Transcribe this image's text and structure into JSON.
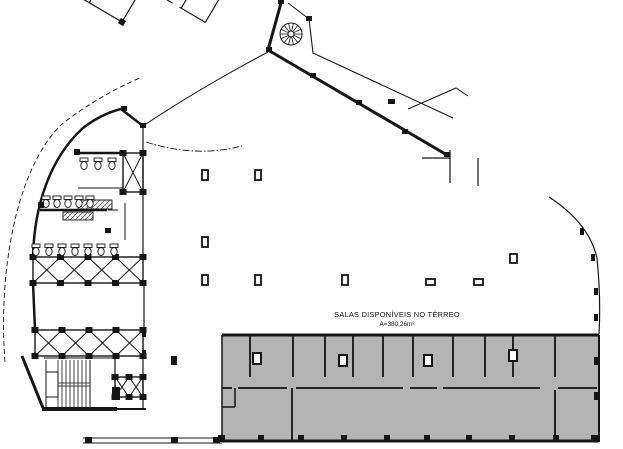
{
  "plan": {
    "labels": {
      "title": "SALAS DISPONÍVEIS NO TÉRREO",
      "area": "A=380,26m²"
    },
    "colors": {
      "line": "#151515",
      "gray_fill": "#b4b4b4",
      "background": "#ffffff"
    },
    "segments": [
      [
        281,
        3,
        268,
        50,
        3
      ],
      [
        268,
        50,
        447,
        155,
        3
      ],
      [
        121,
        109,
        143,
        126,
        2.5
      ],
      [
        77,
        153,
        123,
        153,
        2.5
      ],
      [
        78,
        188,
        123,
        188,
        1
      ],
      [
        40,
        210,
        107,
        210,
        2.5
      ],
      [
        108,
        210,
        118,
        210,
        1
      ],
      [
        125,
        203,
        125,
        240,
        1
      ],
      [
        143,
        126,
        143,
        258,
        1.2
      ],
      [
        144,
        283,
        144,
        330,
        1.2
      ],
      [
        33,
        283,
        35,
        330,
        2.5
      ],
      [
        143,
        357,
        143,
        408,
        1.2
      ],
      [
        44,
        358,
        115,
        358,
        1
      ],
      [
        115,
        358,
        115,
        377,
        1.2
      ],
      [
        46,
        360,
        46,
        407,
        1
      ],
      [
        90,
        360,
        90,
        407,
        1
      ],
      [
        46,
        383,
        90,
        383,
        0.8
      ],
      [
        46,
        386,
        90,
        386,
        0.8
      ],
      [
        22,
        356,
        43,
        408,
        3
      ],
      [
        42,
        409,
        117,
        409,
        4
      ],
      [
        117,
        409,
        146,
        409,
        2
      ],
      [
        83,
        438,
        222,
        438,
        1
      ],
      [
        83,
        443,
        222,
        443,
        1
      ],
      [
        450,
        150,
        450,
        183,
        1.2
      ],
      [
        422,
        158,
        450,
        158,
        1.2
      ],
      [
        478,
        158,
        478,
        186,
        1.2
      ]
    ],
    "rects_outline": [
      [
        46,
        372,
        12,
        25,
        1
      ]
    ],
    "counters": [
      [
        78,
        200,
        34,
        9
      ],
      [
        63,
        212,
        30,
        8
      ]
    ],
    "gray": {
      "rect": [
        222,
        335,
        377,
        107
      ],
      "border": [
        [
          222,
          335,
          599,
          335,
          3
        ],
        [
          599,
          335,
          599,
          442,
          2
        ],
        [
          222,
          441,
          599,
          441,
          3
        ],
        [
          222,
          335,
          222,
          442,
          1.5
        ]
      ],
      "partition_xs": [
        250,
        293,
        325,
        353,
        383,
        413,
        453,
        485,
        513,
        555
      ],
      "partition_y": [
        336,
        377
      ],
      "corridor_y": 388,
      "corridor_segs": [
        [
          222,
          232
        ],
        [
          238,
          287
        ],
        [
          296,
          403
        ],
        [
          410,
          437
        ],
        [
          443,
          540
        ],
        [
          558,
          597
        ]
      ],
      "extra": [
        [
          235,
          388,
          235,
          407,
          1.5
        ],
        [
          222,
          407,
          235,
          407,
          1.5
        ],
        [
          292,
          388,
          292,
          441,
          1.8
        ],
        [
          555,
          390,
          555,
          441,
          1.8
        ]
      ]
    },
    "angled": {
      "rotate": "rotate(30.5 268 50)",
      "segments": [
        [
          0,
          2,
          0,
          58
        ],
        [
          0,
          58,
          14,
          58
        ],
        [
          14,
          58,
          14,
          100
        ],
        [
          14,
          100,
          128,
          100
        ],
        [
          128,
          100,
          128,
          58
        ],
        [
          28,
          2,
          28,
          44
        ],
        [
          58,
          2,
          58,
          26
        ],
        [
          58,
          34,
          58,
          44
        ],
        [
          88,
          2,
          88,
          44
        ],
        [
          112,
          2,
          112,
          20
        ],
        [
          112,
          20,
          140,
          20
        ],
        [
          0,
          44,
          20,
          44
        ],
        [
          26,
          44,
          62,
          44
        ],
        [
          70,
          44,
          88,
          44
        ],
        [
          140,
          2,
          140,
          58
        ],
        [
          140,
          58,
          162,
          58
        ],
        [
          170,
          58,
          200,
          58
        ],
        [
          172,
          2,
          172,
          58
        ],
        [
          200,
          2,
          200,
          58
        ],
        [
          52,
          44,
          52,
          70
        ],
        [
          52,
          78,
          52,
          100
        ],
        [
          90,
          44,
          90,
          72
        ],
        [
          90,
          80,
          90,
          100
        ],
        [
          14,
          74,
          34,
          74
        ]
      ],
      "ticks": [
        [
          28,
          0
        ],
        [
          58,
          0
        ],
        [
          88,
          0
        ],
        [
          140,
          0
        ],
        [
          172,
          0
        ],
        [
          0,
          58
        ],
        [
          128,
          100
        ],
        [
          88,
          44
        ],
        [
          14,
          100
        ],
        [
          112,
          20
        ],
        [
          200,
          2
        ]
      ]
    },
    "stairblock": {
      "rotate": "rotate(28 456 90)",
      "segments": [
        [
          4,
          0,
          170,
          0,
          3
        ],
        [
          0,
          0,
          0,
          40,
          2
        ],
        [
          0,
          40,
          152,
          40,
          1.4
        ],
        [
          56,
          20,
          134,
          20,
          0.8
        ],
        [
          30,
          20,
          150,
          20,
          0.8,
          "5 3"
        ]
      ],
      "rects": [
        [
          152,
          2,
          34,
          36,
          1
        ]
      ],
      "treads": {
        "x1": 56,
        "x2": 134,
        "step": 4,
        "y1": 3,
        "y2": 37
      }
    },
    "stair_left_treads": {
      "x1": 58,
      "x2": 88,
      "step": 4,
      "y1": 360,
      "y2": 407
    },
    "trusses": [
      {
        "x": 33,
        "y": 257,
        "w": 110,
        "h": 26,
        "cells": 4
      },
      {
        "x": 35,
        "y": 330,
        "w": 108,
        "h": 26,
        "cells": 4
      },
      {
        "x": 123,
        "y": 153,
        "w": 20,
        "h": 39,
        "cells": 1
      },
      {
        "x": 115,
        "y": 377,
        "w": 28,
        "h": 20,
        "cells": 2
      },
      {
        "g": "stair",
        "x": 10,
        "y": 2,
        "w": 16,
        "h": 36,
        "cells": 1
      },
      {
        "g": "stair",
        "x": 136,
        "y": 2,
        "w": 16,
        "h": 36,
        "cells": 1
      }
    ],
    "spiral": {
      "cx": 291,
      "cy": 34,
      "r": 11,
      "r2": 3,
      "spokes": 14
    },
    "columns_solid": [
      [
        306,
        16,
        6,
        5
      ],
      [
        266,
        47,
        6,
        5
      ],
      [
        278,
        0,
        6,
        4
      ],
      [
        310,
        73,
        6,
        5
      ],
      [
        356,
        100,
        6,
        5
      ],
      [
        402,
        129,
        6,
        5
      ],
      [
        444,
        152,
        6,
        5
      ],
      [
        388,
        99,
        7,
        5
      ],
      [
        121,
        106,
        6,
        5
      ],
      [
        140,
        123,
        6,
        5
      ],
      [
        74,
        149,
        6,
        6
      ],
      [
        38,
        202,
        6,
        6
      ],
      [
        105,
        228,
        6,
        5
      ],
      [
        142,
        331,
        4,
        6
      ],
      [
        142,
        350,
        4,
        6
      ],
      [
        171,
        356,
        6,
        9
      ],
      [
        112,
        387,
        8,
        13
      ],
      [
        85,
        437,
        7,
        6
      ],
      [
        171,
        437,
        7,
        6
      ],
      [
        213,
        437,
        7,
        6
      ],
      [
        580,
        228,
        4,
        7
      ],
      [
        591,
        254,
        4,
        7
      ],
      [
        594,
        288,
        4,
        7
      ],
      [
        594,
        314,
        4,
        7
      ],
      [
        218,
        435,
        7,
        7
      ],
      [
        258,
        435,
        6,
        7
      ],
      [
        298,
        435,
        6,
        7
      ],
      [
        341,
        435,
        6,
        7
      ],
      [
        384,
        435,
        6,
        7
      ],
      [
        424,
        435,
        6,
        7
      ],
      [
        466,
        435,
        6,
        7
      ],
      [
        509,
        435,
        6,
        7
      ],
      [
        553,
        435,
        6,
        7
      ],
      [
        591,
        435,
        7,
        7
      ],
      [
        594,
        357,
        5,
        8
      ],
      [
        594,
        392,
        5,
        8
      ]
    ],
    "columns_open": [
      [
        202,
        170,
        6,
        10
      ],
      [
        255,
        170,
        6,
        10
      ],
      [
        202,
        237,
        6,
        10
      ],
      [
        202,
        275,
        6,
        10
      ],
      [
        255,
        275,
        6,
        10
      ],
      [
        342,
        275,
        6,
        10
      ],
      [
        426,
        279,
        9,
        6
      ],
      [
        474,
        279,
        9,
        6
      ],
      [
        510,
        254,
        7,
        9
      ]
    ],
    "columns_open_gray": [
      [
        253,
        353,
        8,
        11
      ],
      [
        339,
        355,
        8,
        11
      ],
      [
        424,
        355,
        8,
        11
      ],
      [
        509,
        350,
        8,
        11
      ]
    ],
    "toilets": [
      [
        84,
        158
      ],
      [
        98,
        158
      ],
      [
        112,
        158
      ],
      [
        46,
        196
      ],
      [
        57,
        196
      ],
      [
        68,
        196
      ],
      [
        79,
        196
      ],
      [
        90,
        196
      ],
      [
        36,
        244
      ],
      [
        49,
        244
      ],
      [
        62,
        244
      ],
      [
        75,
        244
      ],
      [
        88,
        244
      ],
      [
        101,
        244
      ],
      [
        114,
        244
      ]
    ]
  }
}
